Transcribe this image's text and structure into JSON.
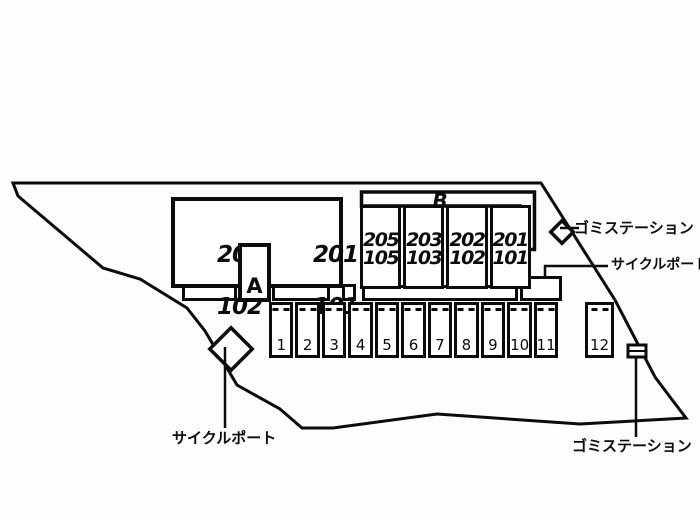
{
  "colors": {
    "line": "#0b0b0b",
    "fill": "#ffffff",
    "background": "#fdfdfd"
  },
  "buildingA": {
    "label": "A",
    "unit_left_top": "202",
    "unit_left_bottom": "102",
    "unit_right_top": "201",
    "unit_right_bottom": "101"
  },
  "buildingB": {
    "label": "B",
    "columns": [
      {
        "top": "205",
        "bottom": "105"
      },
      {
        "top": "203",
        "bottom": "103"
      },
      {
        "top": "202",
        "bottom": "102"
      },
      {
        "top": "201",
        "bottom": "101"
      }
    ]
  },
  "parking": {
    "stalls": [
      "1",
      "2",
      "3",
      "4",
      "5",
      "6",
      "7",
      "8",
      "9",
      "10",
      "11"
    ],
    "stall12": "12"
  },
  "annotations": {
    "garbage_top": "ゴミステーション",
    "cycle_port_right": "サイクルポート",
    "cycle_port_left": "サイクルポート",
    "garbage_bottom": "ゴミステーション"
  }
}
